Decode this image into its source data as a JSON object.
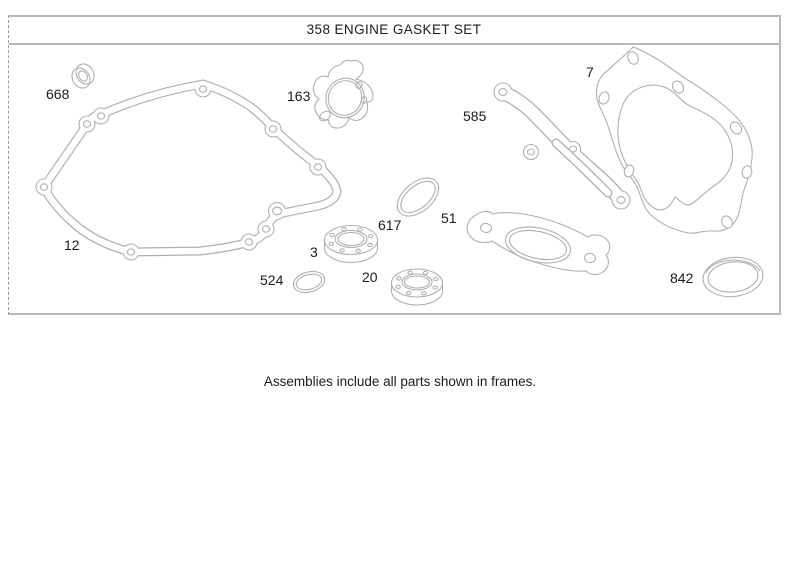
{
  "diagram": {
    "title": "358 ENGINE GASKET SET",
    "caption": "Assemblies include all parts shown in frames."
  },
  "parts": [
    {
      "num": "668"
    },
    {
      "num": "12"
    },
    {
      "num": "163"
    },
    {
      "num": "585"
    },
    {
      "num": "7"
    },
    {
      "num": "617"
    },
    {
      "num": "51"
    },
    {
      "num": "3"
    },
    {
      "num": "524"
    },
    {
      "num": "20"
    },
    {
      "num": "842"
    }
  ],
  "colors": {
    "line_art": "#b0b0b0",
    "frame_border": "#b8b8b8",
    "label_text": "#1c1c1c",
    "background": "#ffffff"
  }
}
